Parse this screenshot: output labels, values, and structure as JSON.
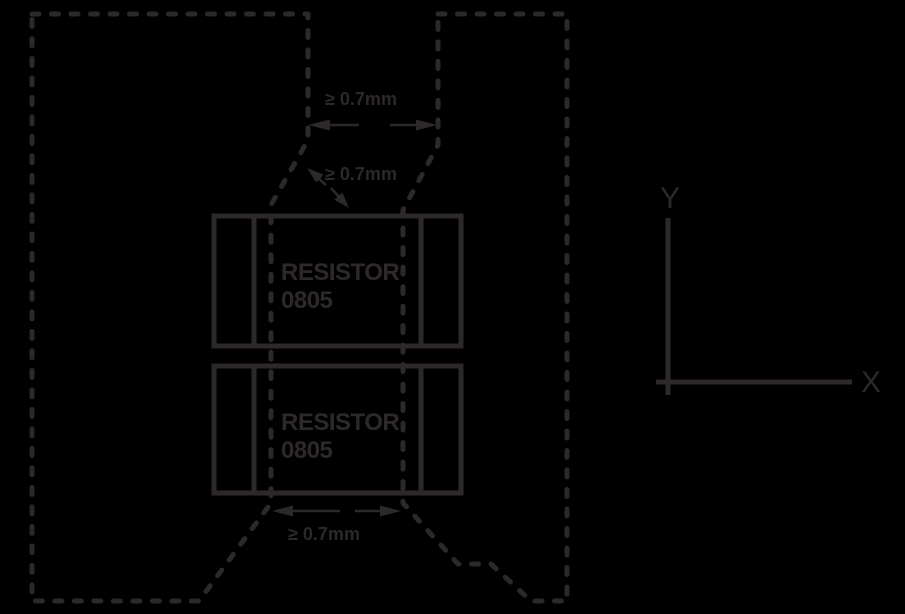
{
  "page": {
    "background_color": "#000000"
  },
  "diagram": {
    "stroke_color": "#2d2829",
    "clearance_labels": {
      "top": "≥ 0.7mm",
      "middle": "≥ 0.7mm",
      "bottom": "≥ 0.7mm"
    },
    "resistor_top": {
      "name": "RESISTOR",
      "package": "0805"
    },
    "resistor_bottom": {
      "name": "RESISTOR",
      "package": "0805"
    },
    "axis": {
      "x": "X",
      "y": "Y"
    }
  }
}
